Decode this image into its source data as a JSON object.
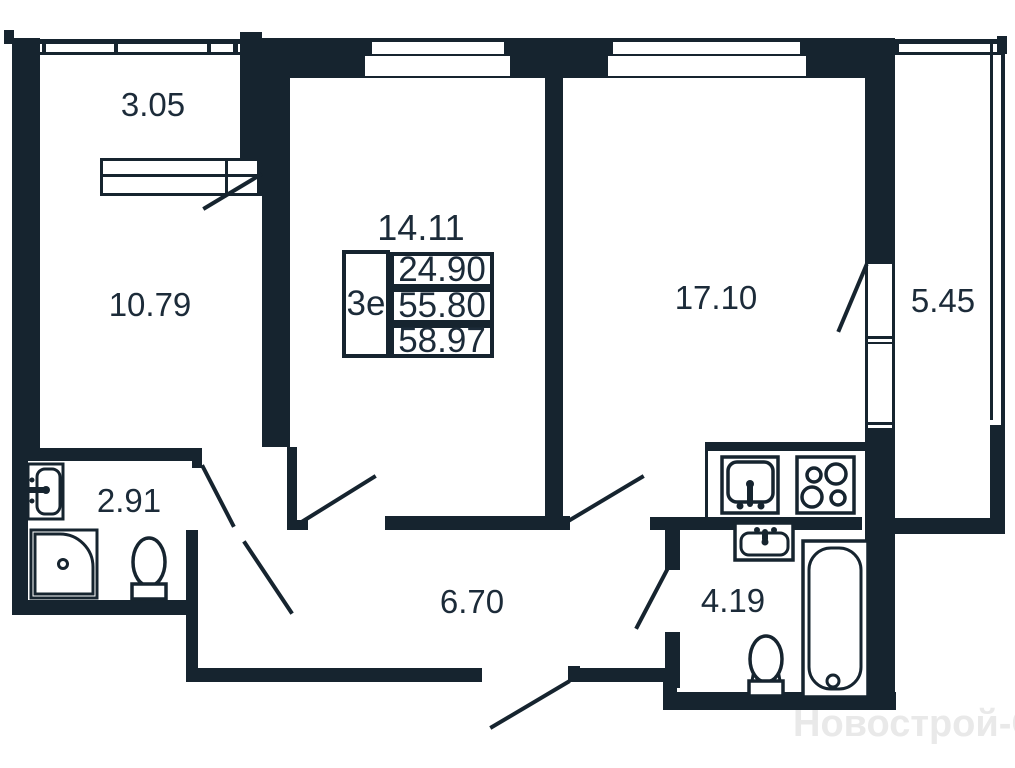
{
  "unit": {
    "type": "3е",
    "area_living": "24.90",
    "area_no_balcony": "55.80",
    "area_total": "58.97"
  },
  "rooms": {
    "balcony_left": "3.05",
    "bedroom": "10.79",
    "living_room": "14.11",
    "kitchen_living": "17.10",
    "balcony_right": "5.45",
    "bathroom_small": "2.91",
    "hallway": "6.70",
    "bathroom_large": "4.19"
  },
  "fixtures": {
    "bathroom_small": [
      "washbasin",
      "shower-tray",
      "toilet"
    ],
    "kitchen": [
      "kitchen-sink",
      "stove"
    ],
    "bathroom_large": [
      "washbasin",
      "toilet",
      "bathtub"
    ]
  },
  "watermark": "Новострой-СПб",
  "colors": {
    "wall": "#16242f",
    "text": "#1c2b39",
    "watermark": "#e9e9e9",
    "background": "#ffffff"
  }
}
